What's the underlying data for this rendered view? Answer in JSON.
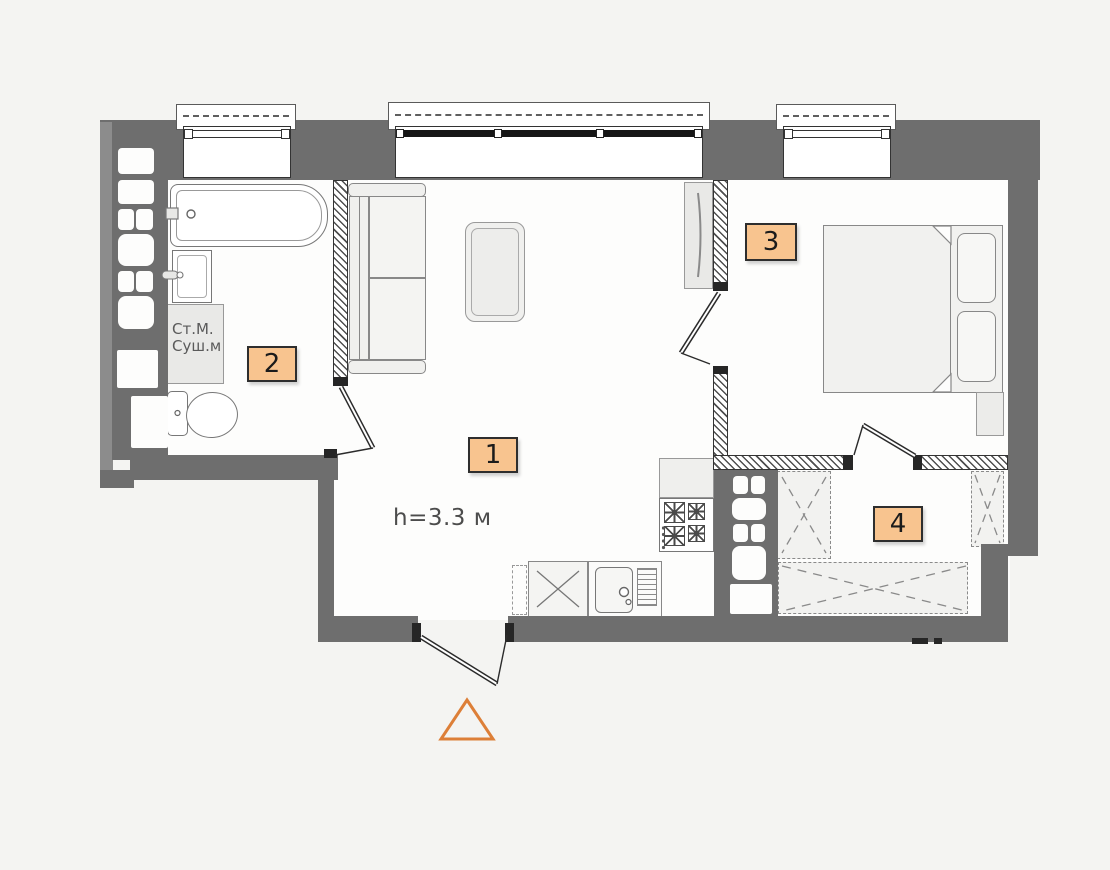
{
  "plan": {
    "room_labels": {
      "living": "1",
      "bathroom": "2",
      "bedroom": "3",
      "wardrobe": "4"
    },
    "ceiling_height_note": "h=3.3 м",
    "washer_dryer": {
      "line1": "Ст.М.",
      "line2": "Суш.м"
    },
    "colors": {
      "room_label_bg": "#f8c48f",
      "room_label_border": "#2e2e2e",
      "wall_gray": "#6e6e6e",
      "entrance_marker_orange": "#dd7f38",
      "hatch_line": "#4f4f4f"
    }
  }
}
